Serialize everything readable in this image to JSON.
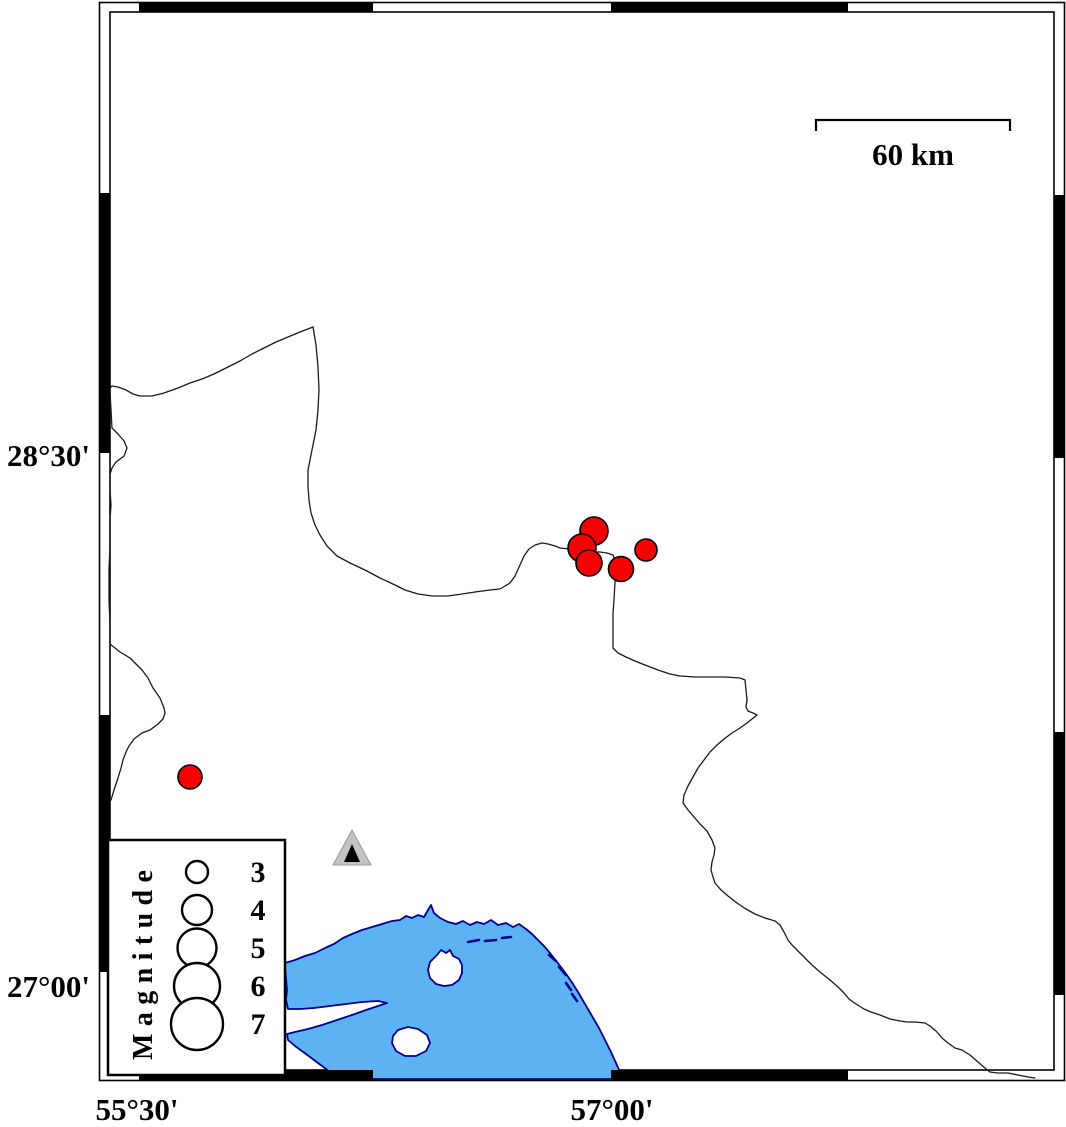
{
  "axis": {
    "lat_top_label": "28°30'",
    "lat_bottom_label": "27°00'",
    "lon_left_label": "55°30'",
    "lon_right_label": "57°00'"
  },
  "scale_bar": {
    "label": "60 km"
  },
  "legend": {
    "title": "Magnitude",
    "entries": [
      {
        "magnitude": "3",
        "radius_px": 11
      },
      {
        "magnitude": "4",
        "radius_px": 15
      },
      {
        "magnitude": "5",
        "radius_px": 19.5
      },
      {
        "magnitude": "6",
        "radius_px": 23
      },
      {
        "magnitude": "7",
        "radius_px": 26
      }
    ]
  },
  "events": [
    {
      "x": 594,
      "y": 531,
      "r": 14
    },
    {
      "x": 582,
      "y": 548,
      "r": 14
    },
    {
      "x": 589,
      "y": 563,
      "r": 13
    },
    {
      "x": 621,
      "y": 569,
      "r": 12.5
    },
    {
      "x": 646,
      "y": 550,
      "r": 11
    },
    {
      "x": 190,
      "y": 777,
      "r": 12
    }
  ],
  "station": {
    "x": 352,
    "y": 848
  },
  "colors": {
    "sea_fill": "#5db3f2",
    "coast_stroke": "#00008b",
    "event_fill": "#f40000",
    "border_stroke": "#1a1a1a",
    "station_fill": "#c3c3c3",
    "station_core": "#000000",
    "frame_black": "#000000"
  }
}
